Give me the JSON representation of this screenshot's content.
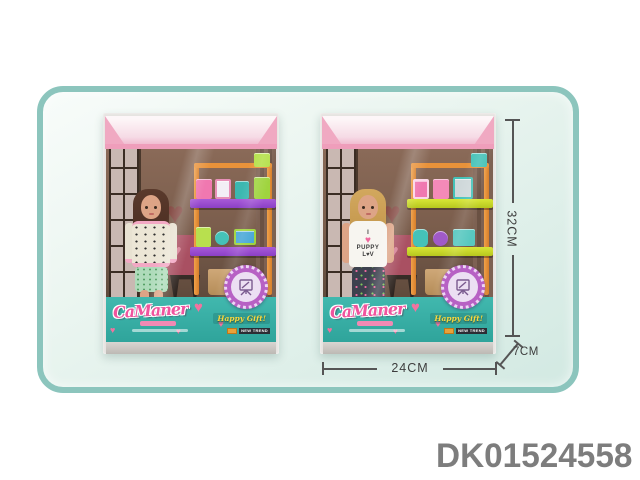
{
  "page": {
    "product_code": "DK01524558"
  },
  "annotations": {
    "height_label": "32CM",
    "width_label": "24CM",
    "depth_label": "7CM"
  },
  "boxes": {
    "brand_logo": "CaManer",
    "happy_gift_label": "Happy Gift!",
    "new_trend_label": "NEW TREND",
    "right_doll": {
      "shirt_line1": "I",
      "shirt_heart": "♥",
      "shirt_line2": "PUPPY",
      "shirt_line3": "L♥V"
    }
  },
  "icons": {
    "badge": "easel-icon",
    "panel_decor": "heart-icon"
  },
  "colors": {
    "frame_border": "#8cc5bd",
    "frame_fill": "#d2e9e2",
    "panel_teal": "#3ab3aa",
    "logo_pink": "#f0549e",
    "shelf_orange": "#e8923a",
    "tray_left_purple": "#8b3fc6",
    "tray_right_yellow": "#c3d429",
    "badge_purple": "#b761c4",
    "happy_gift_yellow": "#f7d83f",
    "ceiling_pink": "#f0a9c2",
    "dimension_line": "#555555",
    "code_gray": "#7d7d7d"
  }
}
